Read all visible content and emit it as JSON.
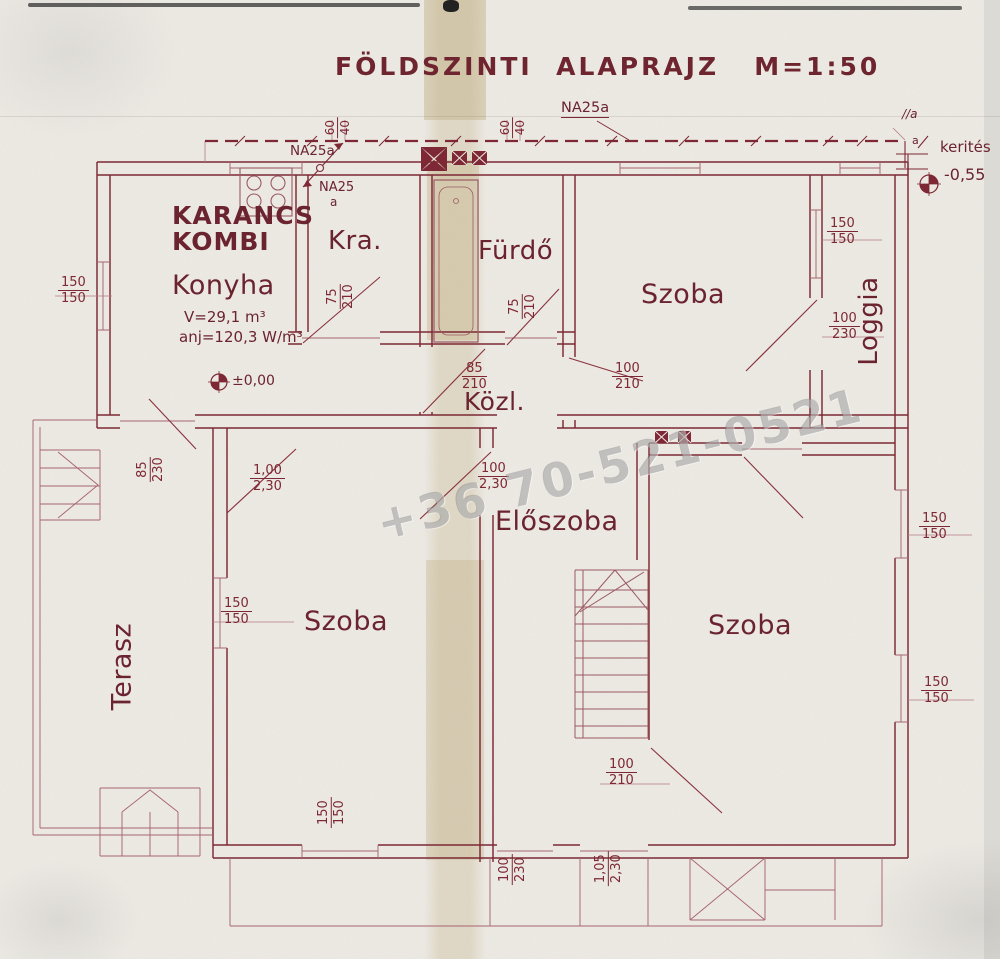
{
  "title": "FÖLDSZINTI  ALAPRAJZ   M=1:50",
  "watermark": "+36 70-521-0521",
  "rooms": {
    "konyha": "Konyha",
    "kra": "Kra.",
    "furdo": "Fürdő",
    "szoba_tr": "Szoba",
    "loggia": "Loggia",
    "kozl": "Közl.",
    "eloszoba": "Előszoba",
    "terasz": "Terasz",
    "szoba_bl": "Szoba",
    "szoba_br": "Szoba"
  },
  "stove": {
    "line1": "KARANCS",
    "line2": "KOMBI"
  },
  "kitchen": {
    "volume": "V=29,1 m³",
    "heat": "anj=120,3 W/m³"
  },
  "levels": {
    "ground": "±0,00",
    "fence": "-0,55"
  },
  "fence": {
    "label": "kerités",
    "mark": "//a",
    "mark2": "a"
  },
  "pipes": {
    "left": "NA25a",
    "mid1": "NA25",
    "mid2": "a",
    "top": "NA25a"
  },
  "dims": {
    "d1": {
      "a": "150",
      "b": "150"
    },
    "d2": {
      "a": "75",
      "b": "210"
    },
    "d3": {
      "a": "75",
      "b": "210"
    },
    "d4": {
      "a": "85",
      "b": "210"
    },
    "d5": {
      "a": "100",
      "b": "210"
    },
    "d6": {
      "a": "150",
      "b": "150"
    },
    "d7": {
      "a": "100",
      "b": "230"
    },
    "d8": {
      "a": "85",
      "b": "230"
    },
    "d9": {
      "a": "1,00",
      "b": "2,30"
    },
    "d10": {
      "a": "100",
      "b": "2,30"
    },
    "d11": {
      "a": "150",
      "b": "150"
    },
    "d12": {
      "a": "150",
      "b": "150"
    },
    "d13": {
      "a": "100",
      "b": "210"
    },
    "d14": {
      "a": "150",
      "b": "150"
    },
    "d15": {
      "a": "150",
      "b": "150"
    },
    "d16": {
      "a": "100",
      "b": "230"
    },
    "d17": {
      "a": "1,05",
      "b": "2,30"
    },
    "d18": {
      "a": "60",
      "b": "40"
    },
    "d19": {
      "a": "60",
      "b": "40"
    }
  },
  "colors": {
    "ink": "#7d2834",
    "ink_light": "#a7656f",
    "paper": "#edeae4",
    "fold": "#c4b286",
    "watermark": "#7a7a7a"
  }
}
